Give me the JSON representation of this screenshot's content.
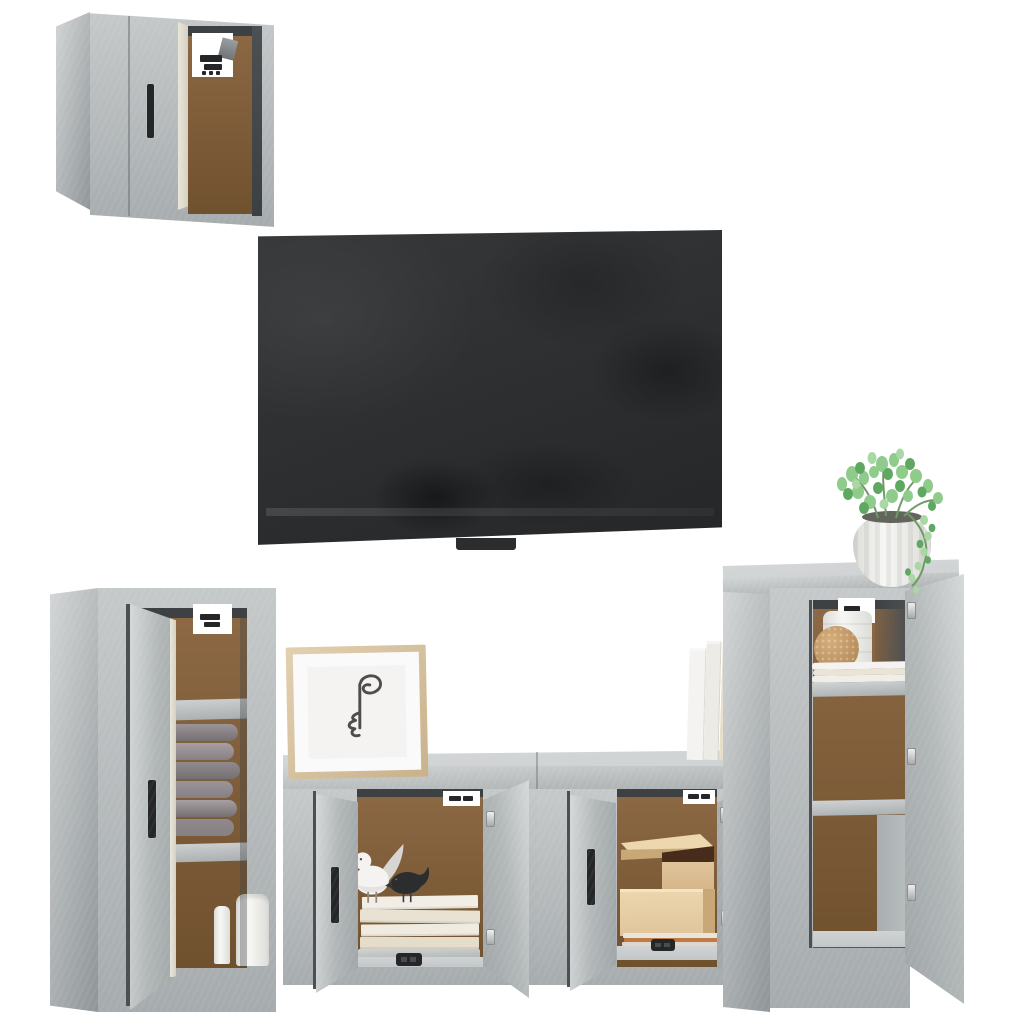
{
  "scene": {
    "type": "product photo",
    "subject": "5-piece TV wall unit set in concrete grey with wall-mounted flat-screen TV and decor props on a white background",
    "objects": [
      "wall cabinet top-left with open door and mounting cutout",
      "wall-mounted flat-screen TV",
      "tall left cabinet with open door, rolled grey towels and white vases",
      "framed abstract one-line face print",
      "TV bench of two units with four open doors holding books, bird figurines, kraft storage boxes and magazines",
      "row of standing books",
      "tall right cabinet with open door, white jar, cork ball and folded towels",
      "green potted plant"
    ]
  },
  "colors": {
    "bg": "#ffffff",
    "concrete_light": "#d3d6d6",
    "concrete_face": "#c5c9ca",
    "concrete_mid": "#b2b7b8",
    "concrete_dark": "#a6abad",
    "concrete_deep": "#8f9598",
    "slab_light": "#d0d3d3",
    "slab_dark": "#a9aeaf",
    "door_hi": "#d6d9da",
    "door_lo": "#a0a6a8",
    "interior_brown": "#8d6945",
    "interior_brown_dark": "#70512e",
    "interior_top_dark": "#3d4144",
    "door_gap": "#4c5053",
    "handle_black": "#242628",
    "tv_base": "#2b2d2f",
    "tv_hi": "#36383a",
    "cream_edge": "#e9e5d9",
    "white_decor": "#f4f3f1",
    "shade_white": "#d8d6d2",
    "beak_gray": "#b9b4ab",
    "bird_black": "#2b2d2e",
    "stack_1": "#f2eee6",
    "stack_2": "#e9e2d2",
    "stack_3": "#f0ebe0",
    "stack_4": "#e4ddcc",
    "book_1": "#f4f3f1",
    "book_2": "#edebe5",
    "book_3": "#e7dfca",
    "book_4": "#dfd6c0",
    "book_5": "#f2f0ea",
    "roll_a": "#9b9598",
    "roll_b": "#867f83",
    "roll_c": "#a79fa3",
    "roll_d": "#757072",
    "roll_e": "#908a8d",
    "kraft_light": "#ecd7ae",
    "kraft": "#e0c49b",
    "kraft_dark": "#c9a878",
    "kraft_lip": "#f4e4c4",
    "box_interior": "#472b1b",
    "magazine_orange": "#c07a48",
    "magazine_gray": "#ddd7cc",
    "magazine_light": "#eae5db",
    "cork": "#bb9260",
    "cork_light": "#d6ae7c",
    "cork_deep": "#a37c4c",
    "towel_cream": "#eae4d6",
    "plant_green": "#8fcb8b",
    "plant_green_dark": "#5fa862",
    "plant_green_light": "#a9d8a4",
    "stem_green": "#6f9a66",
    "pot_white": "#f7f7f5",
    "pot_shade": "#dcdcd8",
    "soil_dark": "#63655c",
    "frame_wood": "#e2d0b0",
    "frame_wood_dark": "#c9b28c",
    "art_bg": "#f4f3f1",
    "line_art": "#4e4d4b",
    "metal_light": "#efefef",
    "metal": "#a8a8a8",
    "floor_gray": "#c3c7c8",
    "legs_gray": "#8c8a88"
  }
}
